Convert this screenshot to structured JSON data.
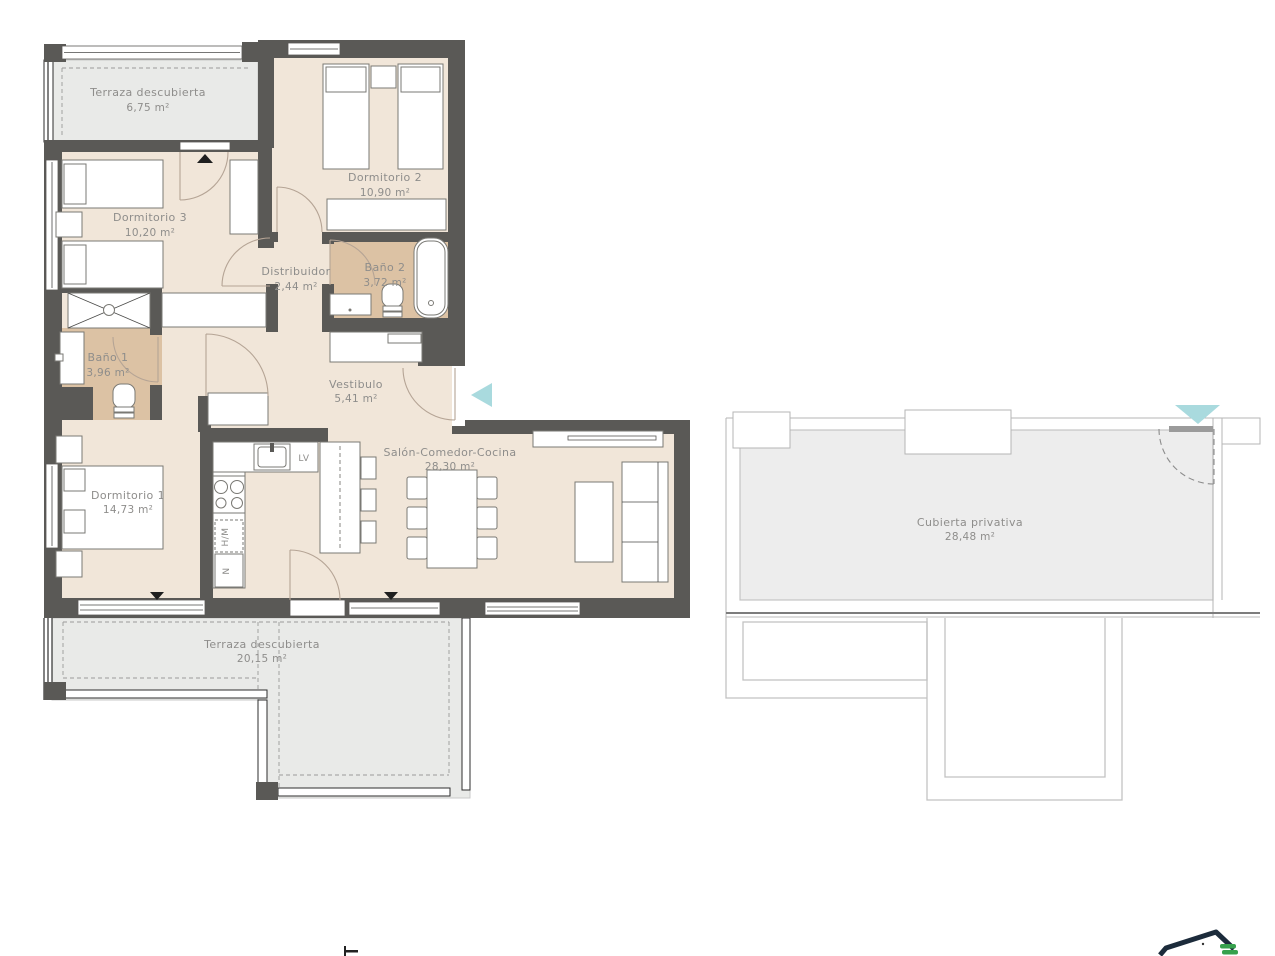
{
  "plan": {
    "title": "apartment-floor-plan",
    "rooms": [
      {
        "id": "terraza-superior",
        "name": "Terraza descubierta",
        "area": "6,75 m²"
      },
      {
        "id": "dormitorio-3",
        "name": "Dormitorio 3",
        "area": "10,20 m²"
      },
      {
        "id": "dormitorio-2",
        "name": "Dormitorio 2",
        "area": "10,90 m²"
      },
      {
        "id": "distribuidor",
        "name": "Distribuidor",
        "area": "2,44 m²"
      },
      {
        "id": "bano-2",
        "name": "Baño 2",
        "area": "3,72 m²"
      },
      {
        "id": "bano-1",
        "name": "Baño 1",
        "area": "3,96 m²"
      },
      {
        "id": "vestibulo",
        "name": "Vestibulo",
        "area": "5,41 m²"
      },
      {
        "id": "dormitorio-1",
        "name": "Dormitorio 1",
        "area": "14,73 m²"
      },
      {
        "id": "salon",
        "name": "Salón-Comedor-Cocina",
        "area": "28,30 m²"
      },
      {
        "id": "terraza-inferior",
        "name": "Terraza descubierta",
        "area": "20,15 m²"
      },
      {
        "id": "cubierta",
        "name": "Cubierta privativa",
        "area": "28,48 m²"
      }
    ],
    "appliances": {
      "dishwasher": "LV",
      "oven_microwave": "H/M",
      "fridge": "N"
    },
    "colors": {
      "wall": "#5a5956",
      "floor": "#f1e6d9",
      "bathroom_floor": "#dcc2a4",
      "terrace": "#e9eae8",
      "entrance_marker": "#a9dade",
      "access_marker": "#1f1f1f",
      "label_text": "#8e8d8b",
      "logo_navy": "#1c2b3b",
      "logo_green": "#36a14d"
    }
  }
}
